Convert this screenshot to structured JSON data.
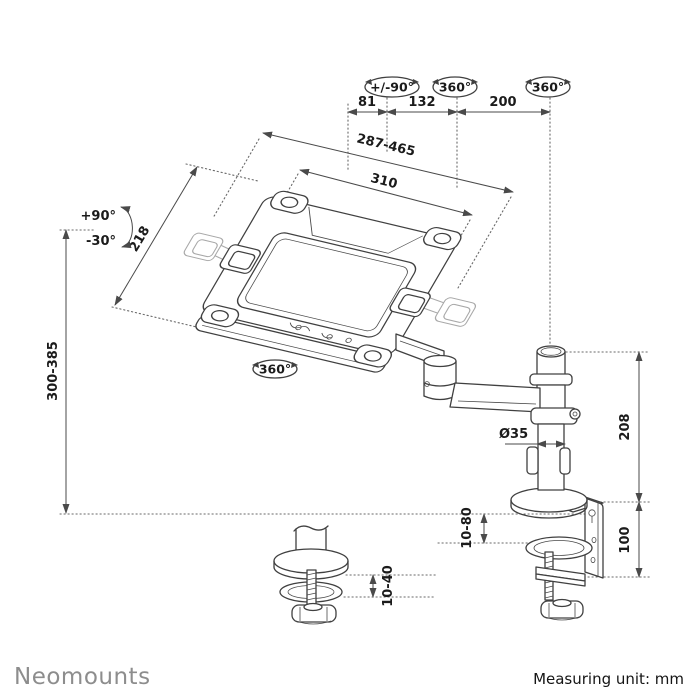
{
  "title": "Laptop desk mount arm dimensional drawing",
  "colors": {
    "background": "#ffffff",
    "line": "#404040",
    "ghost_line": "#a8a8a8",
    "dimension_text": "#1b1b1b",
    "brand_gray": "#8d8d8d"
  },
  "labels": {
    "rotation_tilt_range": "+/-90°",
    "rotation_arm": "360°",
    "rotation_pole": "360°",
    "rotation_tray": "360°",
    "dim_arm_front": "81",
    "dim_arm_mid": "132",
    "dim_arm_rear": "200",
    "dim_tray_width_range": "287-465",
    "dim_tray_plate_width": "310",
    "dim_tray_depth": "218",
    "tilt_up": "+90°",
    "tilt_down": "-30°",
    "dim_height_range": "300-385",
    "dim_pole_diameter": "Ø35",
    "dim_pole_height": "208",
    "dim_clamp_range": "10-80",
    "dim_clamp_height": "100",
    "dim_grommet_range": "10-40"
  },
  "footer": {
    "brand": "Neomounts",
    "measuring_unit": "Measuring unit: mm"
  }
}
